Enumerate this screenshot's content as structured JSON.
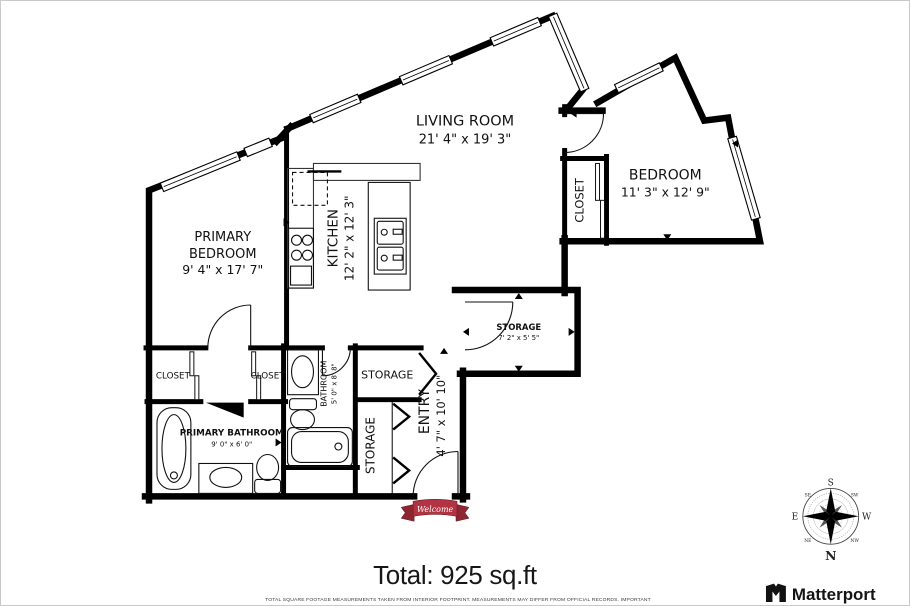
{
  "plan": {
    "rooms": {
      "living": {
        "name": "LIVING ROOM",
        "dims": "21' 4\" x 19' 3\""
      },
      "bedroom": {
        "name": "BEDROOM",
        "dims": "11' 3\" x 12' 9\""
      },
      "primary_bedroom": {
        "name_line1": "PRIMARY",
        "name_line2": "BEDROOM",
        "dims": "9' 4\" x 17' 7\""
      },
      "kitchen": {
        "name": "KITCHEN",
        "dims": "12' 2\" x 12' 3\""
      },
      "storage_main": {
        "name": "STORAGE",
        "dims": "7' 2\" x 5' 5\""
      },
      "entry": {
        "name": "ENTRY",
        "dims": "4' 7\" x 10' 10\""
      },
      "bathroom": {
        "name": "BATHROOM",
        "dims": "5' 0\" x 8' 8\""
      },
      "primary_bathroom": {
        "name": "PRIMARY BATHROOM",
        "dims": "9' 0\" x 6' 0\""
      },
      "storage_upper": {
        "name": "STORAGE"
      },
      "storage_lower": {
        "name": "STORAGE"
      },
      "closet_bedroom": {
        "name": "CLOSET"
      },
      "closet_left": {
        "name": "CLOSET"
      },
      "closet_right": {
        "name": "CLOSET"
      }
    },
    "entry_mat": {
      "text": "Welcome"
    },
    "total": "Total: 925 sq.ft",
    "disclaimer": "TOTAL SQUARE FOOTAGE MEASUREMENTS TAKEN FROM INTERIOR FOOTPRINT. MEASUREMENTS MAY DIFFER FROM OFFICIAL RECORDS. IMPORTANT",
    "compass": {
      "n": "N",
      "s": "S",
      "e": "E",
      "w": "W",
      "ne": "NE",
      "nw": "NW",
      "se": "SE",
      "sw": "SW"
    },
    "brand": {
      "name": "Matterport"
    },
    "colors": {
      "wall": "#000000",
      "ribbon_red": "#b23342",
      "ribbon_dark": "#8f2531",
      "north_red": "#c42127",
      "text": "#1a1a1a"
    }
  }
}
